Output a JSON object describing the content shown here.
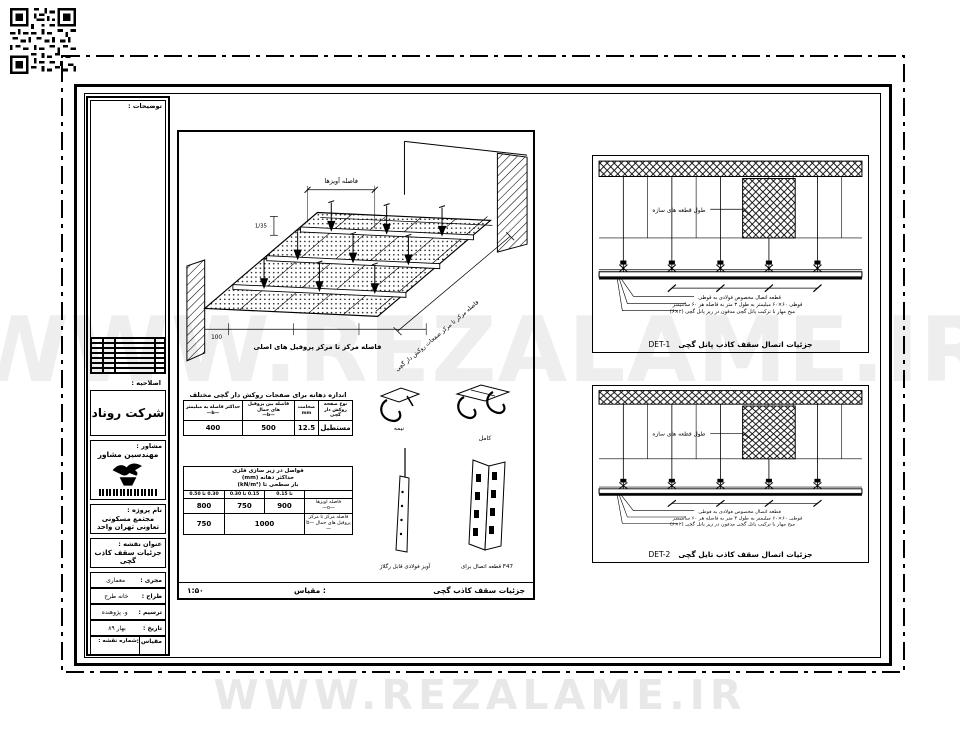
{
  "watermark": {
    "middle": "WWW.REZALAME.IR",
    "bottom": "WWW.REZALAME.IR"
  },
  "titleblock": {
    "notes_label": "توضیحات :",
    "revision_label": "اصلاحیه :",
    "company": "شرکت روناد",
    "consultant_label": "مشاور :",
    "consultant_name": "مهندسین مشاور",
    "project_label": "نام پروژه :",
    "project_name": "مجتمع مسکونی تعاونی تهران واحد",
    "sheet_title_label": "عنوان نقشه :",
    "sheet_title": "جزئیات سقف کاذب گچی",
    "rows": [
      {
        "label": "مجری :",
        "value": "معماری"
      },
      {
        "label": "طراح :",
        "value": "خانه طرح"
      },
      {
        "label": "ترسیم :",
        "value": "و. پژوهنده"
      },
      {
        "label": "تاریخ :",
        "value": "بهار ۸۹"
      }
    ],
    "scale_label": "مقیاس :",
    "sheet_no_label": "شماره نقشه :"
  },
  "main_panel": {
    "iso": {
      "dim_top": "فاصله آویزها",
      "dim_left": "1/35",
      "dim_bottom": "100",
      "caption_bottom": "فاصله مرکز تا مرکز پروفیل های اصلی",
      "dim_right_diag": "فاصله مرکز تا مرکز صفحات روکش دار گچی"
    },
    "table_span": {
      "title": "اندازه دهانه برای صفحات روکش دار گچی مختلف",
      "col_type": "نوع صفحه\nروکش دار گچی",
      "col_thickness": "ضخامت\nmm",
      "col_b1": "فاصله بین پروفیل های حمال\n—b—",
      "col_b2": "حداکثر فاصله به میلیمتر\n—b—",
      "row": {
        "type": "مستطیل",
        "thickness": "12.5",
        "b1": "500",
        "b2": "400"
      }
    },
    "table_spacing": {
      "title": "فواصل در زیر سازی فلزی\nحداکثر دهانه (mm)\nبار سطحی تا (kN/m²)",
      "col1": "تا 0.15",
      "col2": "0.15 تا 0.30",
      "col3": "0.30 تا 0.50",
      "row1_label": "فاصله آویزها\n—o—",
      "row1": [
        "900",
        "750",
        "800"
      ],
      "row2_label": "فاصله مرکز تا مرکز\nپروفیل های حمال —b—",
      "row2_merged": "1000",
      "row2_last": "750"
    },
    "connectors": {
      "half": "نیمه",
      "full": "کامل",
      "hanger": "آویز فولادی قابل رگلاژ",
      "f47": "قطعه اتصال برای F47"
    },
    "caption": "جزئیات سقف کاذب گچی",
    "scale_label": "مقیاس :",
    "scale_value": "۱:۵۰"
  },
  "details": {
    "structure_label": "طول قطعه های سازه",
    "callout1": "قطعه اتصال مخصوص فولادی به قوطی",
    "callout2": "قوطی ۶۰×۶۰ میلیمتر به طول ۳ متر به فاصله هر ۶۰ سانتیمتر",
    "callout3": "میخ مهار با ترکیب پانل گچی مدفون در زیر پانل گچی (۲×۶)",
    "det1": {
      "caption": "جزئیات اتصال سقف کاذب پانل گچی",
      "tag": "DET-1"
    },
    "det2": {
      "caption": "جزئیات اتصال سقف کاذب تایل گچی",
      "tag": "DET-2"
    }
  }
}
